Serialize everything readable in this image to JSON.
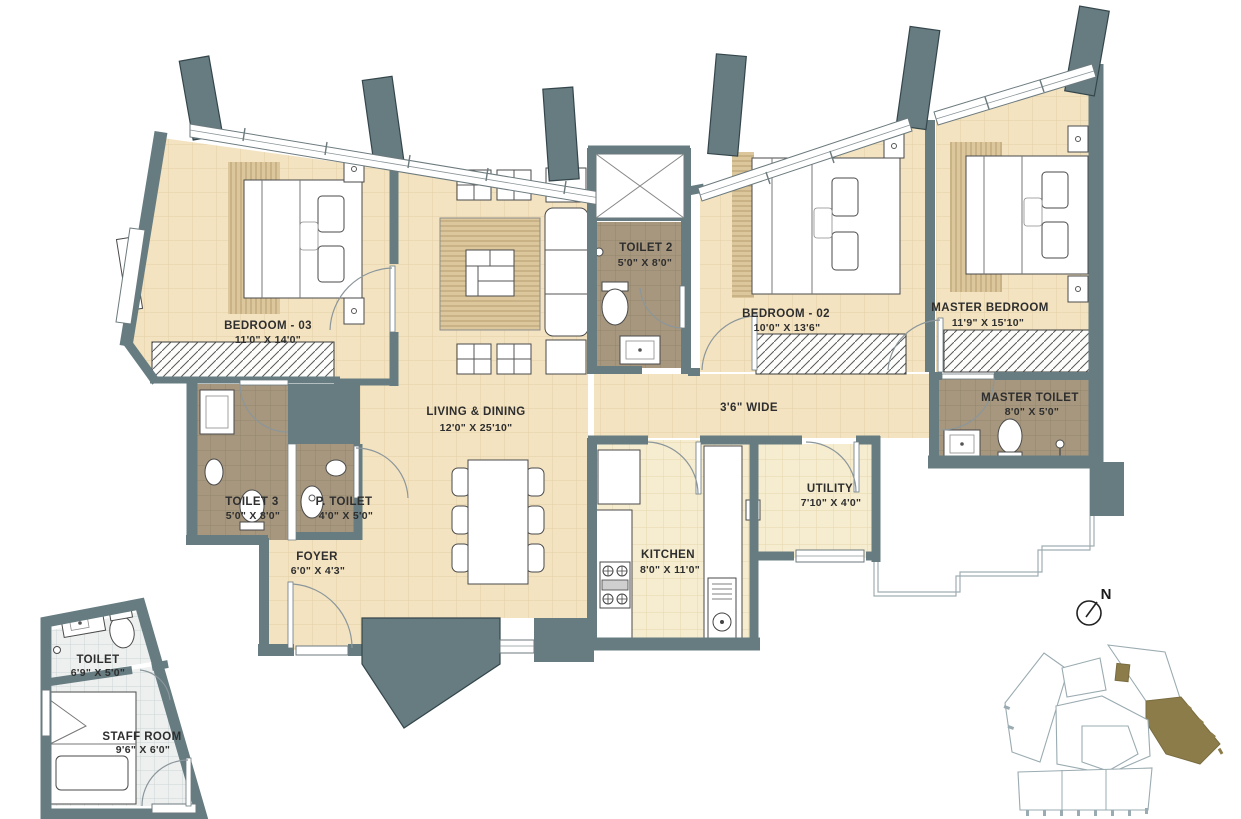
{
  "plan": {
    "rooms": {
      "bedroom3": {
        "name": "BEDROOM - 03",
        "dim": "11'0\" X 14'0\""
      },
      "living": {
        "name": "LIVING & DINING",
        "dim": "12'0\" X 25'10\""
      },
      "toilet2": {
        "name": "TOILET 2",
        "dim": "5'0\" X 8'0\""
      },
      "bedroom2": {
        "name": "BEDROOM - 02",
        "dim": "10'0\" X 13'6\""
      },
      "master_bedroom": {
        "name": "MASTER BEDROOM",
        "dim": "11'9\" X 15'10\""
      },
      "master_toilet": {
        "name": "MASTER TOILET",
        "dim": "8'0\" X 5'0\""
      },
      "toilet3": {
        "name": "TOILET 3",
        "dim": "5'0\" X 8'0\""
      },
      "p_toilet": {
        "name": "P. TOILET",
        "dim": "4'0\" X 5'0\""
      },
      "foyer": {
        "name": "FOYER",
        "dim": "6'0\" X 4'3\""
      },
      "kitchen": {
        "name": "KITCHEN",
        "dim": "8'0\" X 11'0\""
      },
      "utility": {
        "name": "UTILITY",
        "dim": "7'10\" X 4'0\""
      },
      "passage": {
        "name": "3'6\" WIDE"
      },
      "staff_toilet": {
        "name": "TOILET",
        "dim": "6'9\" X 5'0\""
      },
      "staff_room": {
        "name": "STAFF ROOM",
        "dim": "9'6\" X 6'0\""
      }
    },
    "north_label": "N",
    "colors": {
      "wall": "#667c81",
      "floor_beige": "#f3e3c1",
      "toilet_tile": "#a6977e",
      "kitchen_tile": "#f6eccf",
      "keyplan_highlight": "#8b7c4a"
    }
  }
}
